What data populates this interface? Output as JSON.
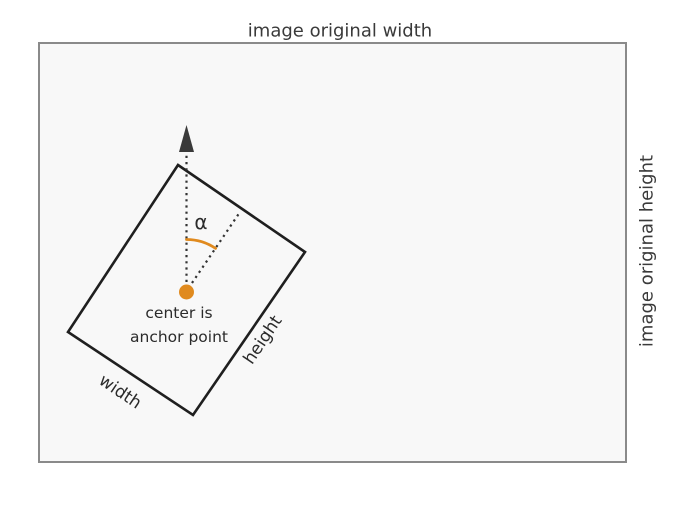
{
  "diagram": {
    "title": "image original width",
    "right_axis_label": "image original height",
    "rotated_box": {
      "width_label": "width",
      "height_label": "height",
      "angle_label": "α",
      "anchor_caption_line1": "center is",
      "anchor_caption_line2": "anchor point"
    },
    "colors": {
      "accent_orange": "#E08A1E",
      "frame_border": "#8A8A8A",
      "frame_fill": "#F8F8F8",
      "shape_stroke": "#1F1F1F",
      "text": "#3A3A3A",
      "page_background": "#FFFFFF"
    }
  }
}
